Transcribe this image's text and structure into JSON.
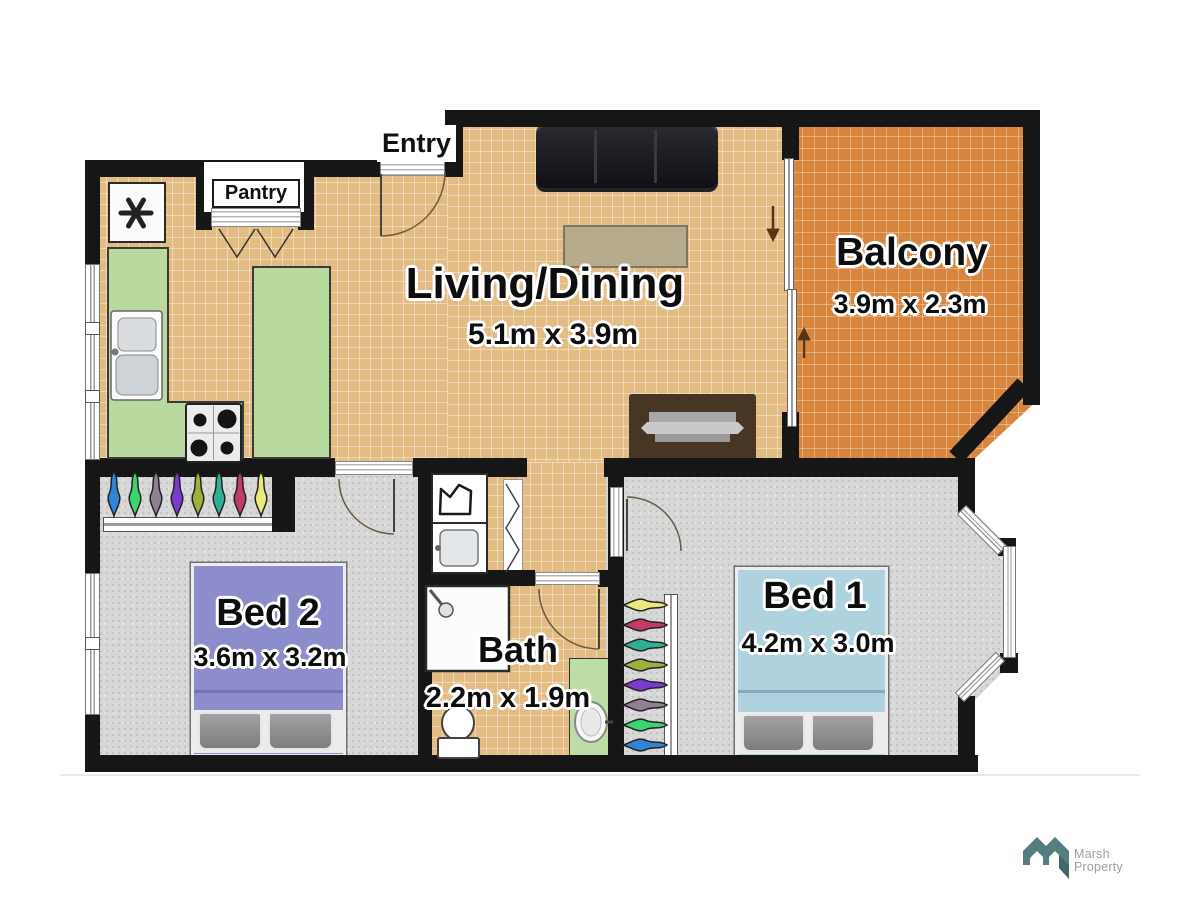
{
  "plan": {
    "rooms": {
      "living": {
        "label": "Living/Dining",
        "dims": "5.1m x 3.9m"
      },
      "balcony": {
        "label": "Balcony",
        "dims": "3.9m x 2.3m"
      },
      "bed1": {
        "label": "Bed 1",
        "dims": "4.2m x 3.0m"
      },
      "bed2": {
        "label": "Bed 2",
        "dims": "3.6m x 3.2m"
      },
      "bath": {
        "label": "Bath",
        "dims": "2.2m x 1.9m"
      }
    },
    "labels": {
      "entry": "Entry",
      "pantry": "Pantry"
    }
  },
  "branding": {
    "line1": "Marsh",
    "line2": "Property"
  },
  "palette": {
    "floor-tan": "#e2bc82",
    "balcony-orange": "#d8863e",
    "carpet-gray": "#d7d7d7",
    "wall-black": "#161616",
    "counter-green": "#b9d99e",
    "mat-green": "#bedca6",
    "bed1-blue": "#afd2df",
    "bed2-purple": "#8d8dcb",
    "logo-teal": "#567e80"
  },
  "icons": {
    "fridge": "asterisk-snowflake-icon",
    "slider_arrows": "up-down-arrow-icons",
    "hanger": "clothes-hanger-icon"
  },
  "hangers": {
    "bed2": [
      "#2f84d6",
      "#3bd46e",
      "#927f94",
      "#7c3bd0",
      "#9cb23c",
      "#2fb096",
      "#c23a68",
      "#ece87e"
    ],
    "bed1": [
      "#ece87e",
      "#c23a68",
      "#2fb096",
      "#9cb23c",
      "#7c3bd0",
      "#927f94",
      "#3bd46e",
      "#2f84d6"
    ]
  }
}
